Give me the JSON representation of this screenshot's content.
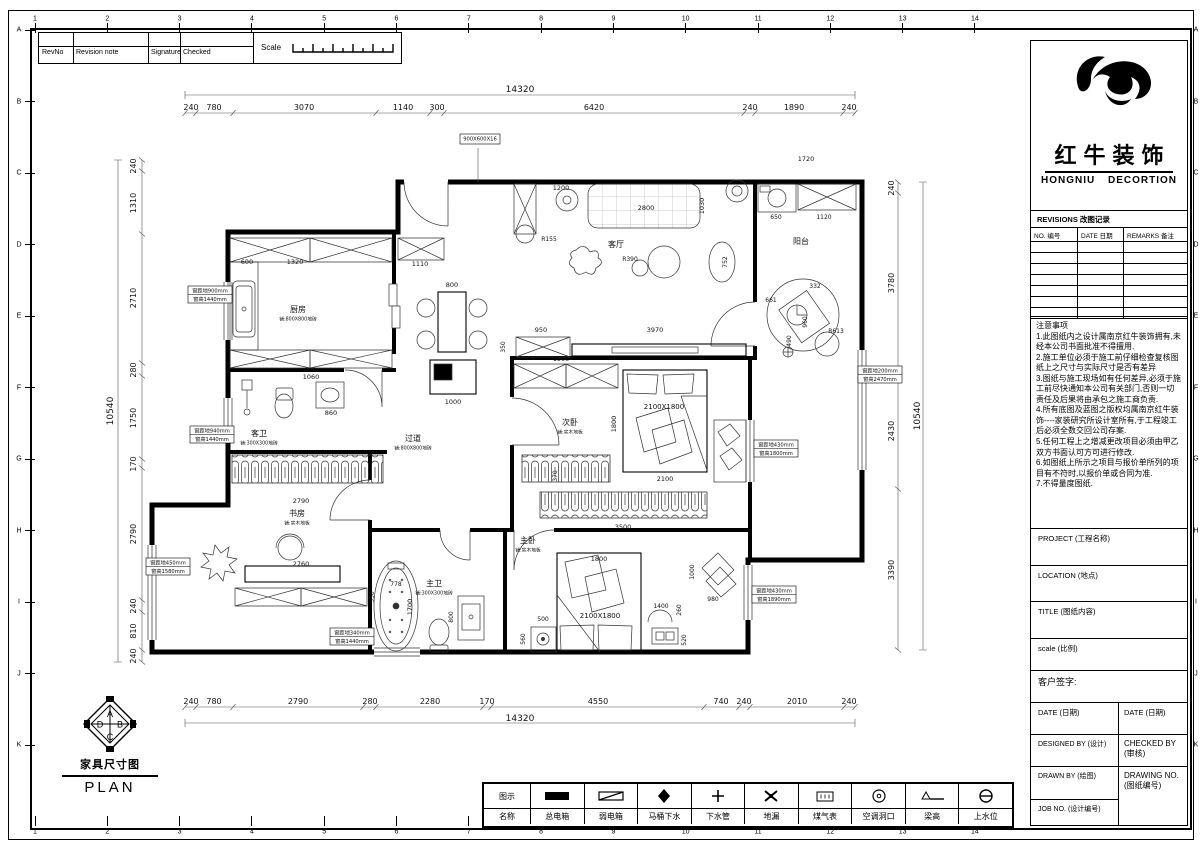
{
  "grid": {
    "cols": [
      "1",
      "2",
      "3",
      "4",
      "5",
      "6",
      "7",
      "8",
      "9",
      "10",
      "11",
      "12",
      "13",
      "14"
    ],
    "rows": [
      "A",
      "B",
      "C",
      "D",
      "E",
      "F",
      "G",
      "H",
      "I",
      "J",
      "K"
    ]
  },
  "rev_table": {
    "headers": [
      "RevNo",
      "Revision note",
      "Signature",
      "Checked"
    ],
    "scale_label": "Scale"
  },
  "plan_footer": {
    "title": "家具尺寸图",
    "subtitle": "PLAN",
    "compass": [
      "A",
      "B",
      "C",
      "D"
    ]
  },
  "title_block": {
    "company_cn": "红牛装饰",
    "company_en_1": "HONGNIU",
    "company_en_2": "DECORTION",
    "revisions_title": "REVISIONS 改图记录",
    "revisions_headers": [
      "NO. 编号",
      "DATE 日期",
      "REMARKS 备注"
    ],
    "notes_title": "注意事项",
    "notes": [
      "1.此图纸内之设计属南京红牛装饰拥有,未经本公司书面批准不得擅用.",
      "2.施工单位必须于施工前仔细检查复核图纸上之尺寸与实际尺寸是否有差异",
      "3.图纸与施工现场如有任何差异,必须于施工前尽快通知本公司有关部门,否则一切责任及后果将由承包之施工商负责.",
      "4.所有底图及蓝图之版权均属南京红牛装饰----家装研究所设计室所有,于工程竣工后必须全数交回公司存案.",
      "5.任何工程上之增减更改项目必须由甲乙双方书面认可方可进行修改.",
      "6.如图纸上所示之项目与报价单所列的项目有不符时,以报价单或合同为准.",
      "7.不得量度图纸."
    ],
    "project_label": "PROJECT (工程名称)",
    "location_label": "LOCATION (地点)",
    "title_label": "TITLE (图纸内容)",
    "scale_label": "scale (比例)",
    "signature_label": "客户签字:",
    "date_left": "DATE (日期)",
    "date_right": "DATE (日期)",
    "designed_by": "DESIGNED BY (设计)",
    "checked_by": "CHECKED BY (审核)",
    "drawn_by": "DRAWN BY (绘图)",
    "drawing_no": "DRAWING NO. (图纸编号)",
    "job_no": "JOB NO. (设计编号)"
  },
  "legend": {
    "header_symbol": "图示",
    "header_name": "名称",
    "items": [
      {
        "name": "总电箱",
        "icon": "main-electric-box"
      },
      {
        "name": "弱电箱",
        "icon": "weak-electric-box"
      },
      {
        "name": "马桶下水",
        "icon": "toilet-drain"
      },
      {
        "name": "下水管",
        "icon": "drain-pipe"
      },
      {
        "name": "地漏",
        "icon": "floor-drain"
      },
      {
        "name": "煤气表",
        "icon": "gas-meter"
      },
      {
        "name": "空调洞口",
        "icon": "ac-hole"
      },
      {
        "name": "梁高",
        "icon": "beam-height"
      },
      {
        "name": "上水位",
        "icon": "water-supply"
      }
    ]
  },
  "plan": {
    "rooms": [
      {
        "label": "厨房",
        "sub": "铺:800X800地砖",
        "x": 298,
        "y": 312
      },
      {
        "label": "客厅",
        "sub": "",
        "x": 616,
        "y": 247
      },
      {
        "label": "阳台",
        "sub": "",
        "x": 801,
        "y": 244
      },
      {
        "label": "过道",
        "sub": "铺:800X800地砖",
        "x": 413,
        "y": 441
      },
      {
        "label": "客卫",
        "sub": "铺:300X300地砖",
        "x": 259,
        "y": 436
      },
      {
        "label": "次卧",
        "sub": "铺:实木地板",
        "x": 570,
        "y": 425
      },
      {
        "label": "书房",
        "sub": "铺:实木地板",
        "x": 297,
        "y": 516
      },
      {
        "label": "主卫",
        "sub": "铺:300X300地砖",
        "x": 434,
        "y": 586
      },
      {
        "label": "主卧",
        "sub": "铺:实木地板",
        "x": 528,
        "y": 543
      }
    ],
    "windows": [
      {
        "x": 188,
        "y": 286,
        "l1": "窗距地900mm",
        "l2": "窗高1440mm"
      },
      {
        "x": 190,
        "y": 426,
        "l1": "窗距地940mm",
        "l2": "窗高1440mm"
      },
      {
        "x": 146,
        "y": 558,
        "l1": "窗距地450mm",
        "l2": "窗高1580mm"
      },
      {
        "x": 330,
        "y": 628,
        "l1": "窗距地340mm",
        "l2": "窗高1440mm"
      },
      {
        "x": 858,
        "y": 366,
        "l1": "窗距地200mm",
        "l2": "窗高2470mm"
      },
      {
        "x": 754,
        "y": 440,
        "l1": "窗距地430mm",
        "l2": "窗高1800mm"
      },
      {
        "x": 752,
        "y": 586,
        "l1": "窗距地430mm",
        "l2": "窗高1890mm"
      },
      {
        "x": 460,
        "y": 134,
        "l1": "900X600X16",
        "l2": "",
        "w": 40
      }
    ],
    "texts": [
      {
        "t": "14320",
        "x": 520,
        "y": 92,
        "s": 9
      },
      {
        "t": "240",
        "x": 191,
        "y": 110,
        "s": 8
      },
      {
        "t": "780",
        "x": 214,
        "y": 110,
        "s": 8
      },
      {
        "t": "3070",
        "x": 304,
        "y": 110,
        "s": 8
      },
      {
        "t": "1140",
        "x": 403,
        "y": 110,
        "s": 8
      },
      {
        "t": "300",
        "x": 437,
        "y": 110,
        "s": 8
      },
      {
        "t": "6420",
        "x": 594,
        "y": 110,
        "s": 8
      },
      {
        "t": "240",
        "x": 750,
        "y": 110,
        "s": 8
      },
      {
        "t": "1890",
        "x": 794,
        "y": 110,
        "s": 8
      },
      {
        "t": "240",
        "x": 849,
        "y": 110,
        "s": 8
      },
      {
        "t": "14320",
        "x": 520,
        "y": 721,
        "s": 9
      },
      {
        "t": "240",
        "x": 191,
        "y": 704,
        "s": 8
      },
      {
        "t": "780",
        "x": 214,
        "y": 704,
        "s": 8
      },
      {
        "t": "2790",
        "x": 298,
        "y": 704,
        "s": 8
      },
      {
        "t": "280",
        "x": 370,
        "y": 704,
        "s": 8
      },
      {
        "t": "2280",
        "x": 430,
        "y": 704,
        "s": 8
      },
      {
        "t": "170",
        "x": 487,
        "y": 704,
        "s": 8
      },
      {
        "t": "4550",
        "x": 598,
        "y": 704,
        "s": 8
      },
      {
        "t": "740",
        "x": 721,
        "y": 704,
        "s": 8
      },
      {
        "t": "240",
        "x": 744,
        "y": 704,
        "s": 8
      },
      {
        "t": "2010",
        "x": 797,
        "y": 704,
        "s": 8
      },
      {
        "t": "240",
        "x": 849,
        "y": 704,
        "s": 8
      },
      {
        "t": "10540",
        "x": 113,
        "y": 411,
        "r": 1,
        "s": 9
      },
      {
        "t": "240",
        "x": 136,
        "y": 166,
        "r": 1,
        "s": 8
      },
      {
        "t": "1310",
        "x": 136,
        "y": 203,
        "r": 1,
        "s": 8
      },
      {
        "t": "2710",
        "x": 136,
        "y": 298,
        "r": 1,
        "s": 8
      },
      {
        "t": "280",
        "x": 136,
        "y": 370,
        "r": 1,
        "s": 8
      },
      {
        "t": "1750",
        "x": 136,
        "y": 418,
        "r": 1,
        "s": 8
      },
      {
        "t": "170",
        "x": 136,
        "y": 464,
        "r": 1,
        "s": 8
      },
      {
        "t": "2790",
        "x": 136,
        "y": 534,
        "r": 1,
        "s": 8
      },
      {
        "t": "240",
        "x": 136,
        "y": 606,
        "r": 1,
        "s": 8
      },
      {
        "t": "810",
        "x": 136,
        "y": 631,
        "r": 1,
        "s": 8
      },
      {
        "t": "240",
        "x": 136,
        "y": 656,
        "r": 1,
        "s": 8
      },
      {
        "t": "10540",
        "x": 920,
        "y": 416,
        "r": 1,
        "s": 9
      },
      {
        "t": "240",
        "x": 894,
        "y": 188,
        "r": 1,
        "s": 8
      },
      {
        "t": "3780",
        "x": 894,
        "y": 283,
        "r": 1,
        "s": 8
      },
      {
        "t": "2430",
        "x": 894,
        "y": 431,
        "r": 1,
        "s": 8
      },
      {
        "t": "3390",
        "x": 894,
        "y": 570,
        "r": 1,
        "s": 8
      },
      {
        "t": "600",
        "x": 247,
        "y": 264
      },
      {
        "t": "1320",
        "x": 295,
        "y": 264
      },
      {
        "t": "1110",
        "x": 420,
        "y": 266
      },
      {
        "t": "800",
        "x": 452,
        "y": 287
      },
      {
        "t": "1000",
        "x": 453,
        "y": 404
      },
      {
        "t": "1060",
        "x": 311,
        "y": 379
      },
      {
        "t": "860",
        "x": 331,
        "y": 415
      },
      {
        "t": "1200",
        "x": 561,
        "y": 190
      },
      {
        "t": "2800",
        "x": 646,
        "y": 210
      },
      {
        "t": "1030",
        "x": 704,
        "y": 206,
        "r": 1
      },
      {
        "t": "R390",
        "x": 630,
        "y": 261,
        "s": 6
      },
      {
        "t": "752",
        "x": 727,
        "y": 262,
        "r": 1,
        "s": 6
      },
      {
        "t": "R155",
        "x": 549,
        "y": 241,
        "s": 6
      },
      {
        "t": "950",
        "x": 541,
        "y": 332
      },
      {
        "t": "3970",
        "x": 655,
        "y": 332
      },
      {
        "t": "350",
        "x": 505,
        "y": 347,
        "r": 1,
        "s": 6
      },
      {
        "t": "1720",
        "x": 806,
        "y": 161
      },
      {
        "t": "650",
        "x": 776,
        "y": 219,
        "s": 6
      },
      {
        "t": "1120",
        "x": 824,
        "y": 219,
        "s": 6
      },
      {
        "t": "R613",
        "x": 836,
        "y": 333,
        "s": 6
      },
      {
        "t": "661",
        "x": 771,
        "y": 302,
        "s": 6
      },
      {
        "t": "332",
        "x": 815,
        "y": 288,
        "s": 6
      },
      {
        "t": "960",
        "x": 807,
        "y": 322,
        "r": 1,
        "s": 6
      },
      {
        "t": "490",
        "x": 791,
        "y": 341,
        "r": 1,
        "s": 6
      },
      {
        "t": "1500",
        "x": 561,
        "y": 361
      },
      {
        "t": "2100X1800",
        "x": 664,
        "y": 409,
        "s": 7
      },
      {
        "t": "2100",
        "x": 665,
        "y": 481
      },
      {
        "t": "1800",
        "x": 616,
        "y": 424,
        "r": 1
      },
      {
        "t": "370",
        "x": 557,
        "y": 476,
        "r": 1,
        "s": 6
      },
      {
        "t": "3500",
        "x": 623,
        "y": 529
      },
      {
        "t": "550",
        "x": 374,
        "y": 597,
        "r": 1,
        "s": 6
      },
      {
        "t": "2790",
        "x": 301,
        "y": 503
      },
      {
        "t": "2760",
        "x": 301,
        "y": 566
      },
      {
        "t": "2100X1800",
        "x": 600,
        "y": 618,
        "s": 7
      },
      {
        "t": "1800",
        "x": 599,
        "y": 561
      },
      {
        "t": "500",
        "x": 543,
        "y": 621,
        "s": 6
      },
      {
        "t": "560",
        "x": 525,
        "y": 639,
        "r": 1,
        "s": 6
      },
      {
        "t": "1400",
        "x": 661,
        "y": 608,
        "s": 6
      },
      {
        "t": "980",
        "x": 713,
        "y": 601,
        "s": 6
      },
      {
        "t": "1000",
        "x": 694,
        "y": 572,
        "r": 1,
        "s": 6
      },
      {
        "t": "520",
        "x": 686,
        "y": 640,
        "r": 1,
        "s": 6
      },
      {
        "t": "260",
        "x": 681,
        "y": 610,
        "r": 1,
        "s": 6
      },
      {
        "t": "1700",
        "x": 412,
        "y": 607,
        "r": 1
      },
      {
        "t": "778",
        "x": 396,
        "y": 586,
        "s": 6
      },
      {
        "t": "800",
        "x": 453,
        "y": 617,
        "r": 1,
        "s": 6
      }
    ]
  }
}
